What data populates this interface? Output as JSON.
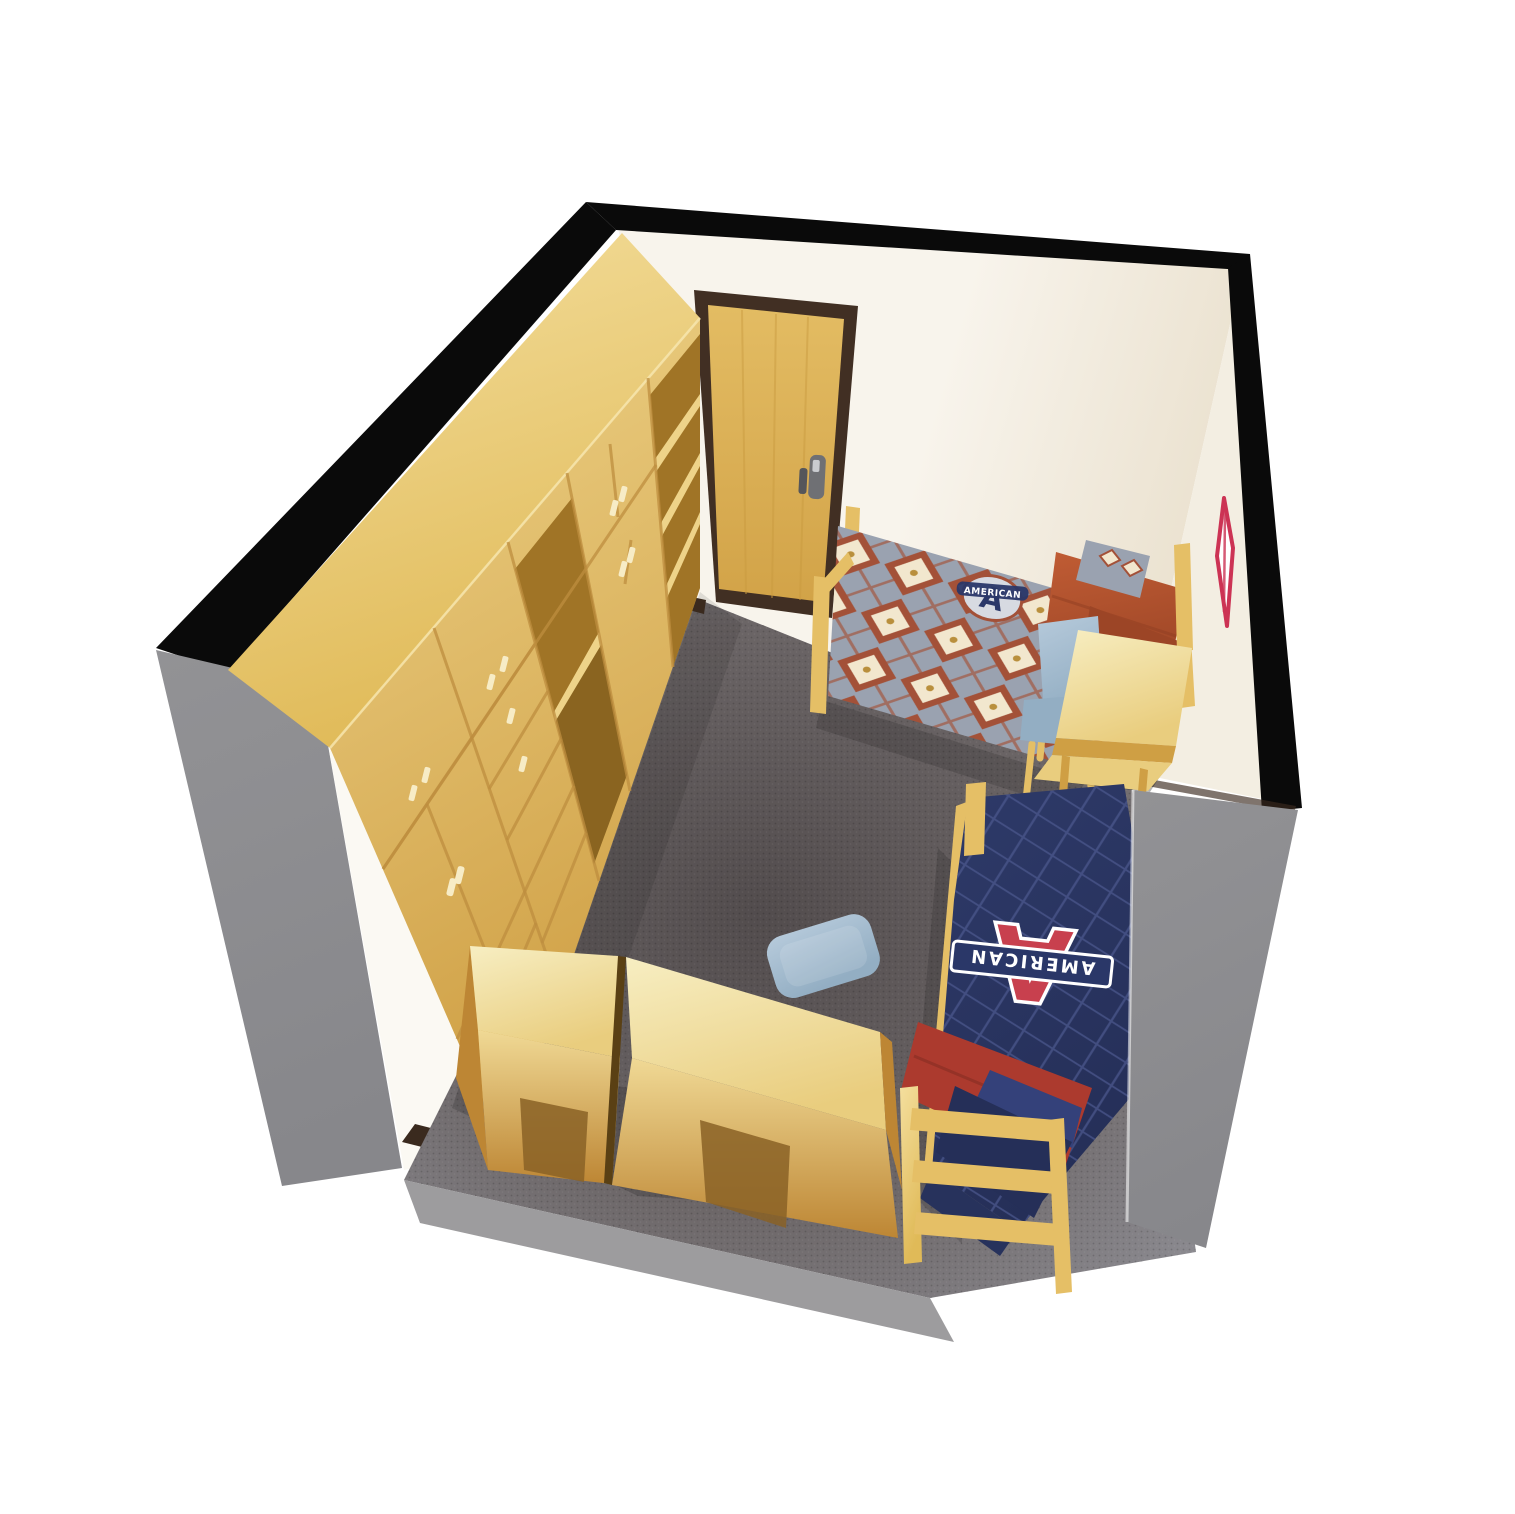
{
  "scene": {
    "description": "3D cutaway rendering of a furnished residence-hall double room seen from above: wardrobe wall with cabinets and drawers, entry door, two twin beds with university bedding, desks and blue chairs on gray carpet",
    "logo_text": "AMERICAN",
    "logo_letter": "A"
  },
  "colors": {
    "background": "#ffffff",
    "cut_edge_black": "#0a0a0a",
    "wall_exterior_gray": "#8e8e90",
    "wall_cut_gray": "#929295",
    "wall_white": "#f8f4ec",
    "wall_cream": "#ebe2d0",
    "wall_right": "#f3eee2",
    "wall_sliver": "#fbf9f3",
    "baseboard_brown": "#3a2a1e",
    "floor_edge_gray": "#9d9c9e",
    "carpet_dark": "#524c4d",
    "carpet_mid": "#6b6566",
    "carpet_light": "#8d8c92",
    "wood_top_light": "#f4df9e",
    "wood_top_dark": "#e0ba58",
    "wood_front_light": "#eed389",
    "wood_front_dark": "#cf9f44",
    "wood_interior_dark": "#a07426",
    "wood_interior_deep": "#8a6420",
    "wood_seam": "#bd8e3f",
    "wood_handle": "#f7ecc6",
    "door_frame_brown": "#412f23",
    "door_wood_light": "#e3bc63",
    "door_wood_dark": "#d2a348",
    "door_lock_gray": "#6f7074",
    "desk_top_light": "#f7eec2",
    "desk_top_dark": "#e9cd7e",
    "desk_front_light": "#f0d995",
    "desk_front_dark": "#bd8634",
    "desk_notch_dark": "#8a6226",
    "bed_frame_wood": "#e5bf66",
    "bed1_base": "#9aa2b0",
    "bed1_cream": "#f2e7ce",
    "bed1_rust": "#a35138",
    "bed1_gold": "#b98f3c",
    "rust_light": "#c05c34",
    "rust_dark": "#9c4526",
    "chair_blue_light": "#b6cadb",
    "chair_blue_dark": "#93aec3",
    "navy_quilt": "#2e3a69",
    "navy_quilt_line": "#4a568c",
    "navy_dark": "#252f58",
    "red_blanket": "#ac3a2e",
    "logo_red": "#c8404e",
    "logo_navy": "#2a3768",
    "logo_white": "#ffffff",
    "pennant_red": "#cc3354",
    "shadow": "#000000"
  }
}
